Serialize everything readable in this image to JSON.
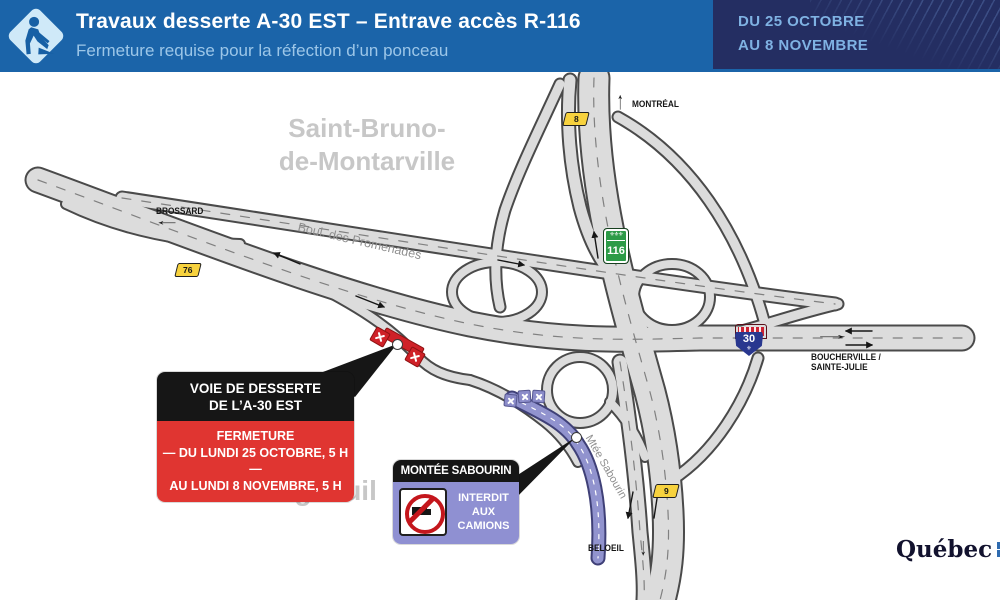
{
  "header": {
    "title": "Travaux desserte A-30 EST – Entrave accès R-116",
    "subtitle": "Fermeture requise pour la réfection d’un ponceau",
    "date_line1": "DU 25 OCTOBRE",
    "date_line2": "AU 8 NOVEMBRE"
  },
  "labels": {
    "saint_bruno_1": "Saint-Bruno-",
    "saint_bruno_2": "de-Montarville",
    "longueuil": "Longueuil",
    "brossard": "BROSSARD",
    "montreal": "MONTRÉAL",
    "boucherville_1": "BOUCHERVILLE /",
    "boucherville_2": "SAINTE-JULIE",
    "beloeil": "BELOEIL",
    "promenades": "Boul. des Promenades",
    "sabourin": "Mtée Sabourin"
  },
  "shields": {
    "exit8": "8",
    "exit76": "76",
    "exit9": "9",
    "route116": "116",
    "autoroute30": "30"
  },
  "callouts": {
    "desserte": {
      "title_line1": "VOIE DE DESSERTE",
      "title_line2": "DE L’A-30 EST",
      "body_line1": "FERMETURE",
      "body_line2": "— DU LUNDI 25 OCTOBRE, 5 H —",
      "body_line3": "AU LUNDI 8 NOVEMBRE, 5 H"
    },
    "sabourin": {
      "title": "MONTÉE SABOURIN",
      "body_line1": "INTERDIT",
      "body_line2": "AUX",
      "body_line3": "CAMIONS"
    }
  },
  "icons": {
    "up_arrow": "↑",
    "down_arrow": "↓",
    "left_arrow": "←",
    "right_arrow": "→",
    "fleur": "⚜",
    "fleur_row": "⚜⚜⚜"
  },
  "footer": {
    "logo_text": "Québec"
  },
  "colors": {
    "header_blue": "#1b64a9",
    "date_panel_navy": "#242e62",
    "closure_red": "#cf2128",
    "callout_red": "#e03531",
    "callout_purple": "#8f90d2",
    "road_purple": "#9193ce",
    "shield_yellow": "#f7d23e",
    "shield_green": "#2c9b47",
    "autoroute_blue": "#29378f"
  }
}
